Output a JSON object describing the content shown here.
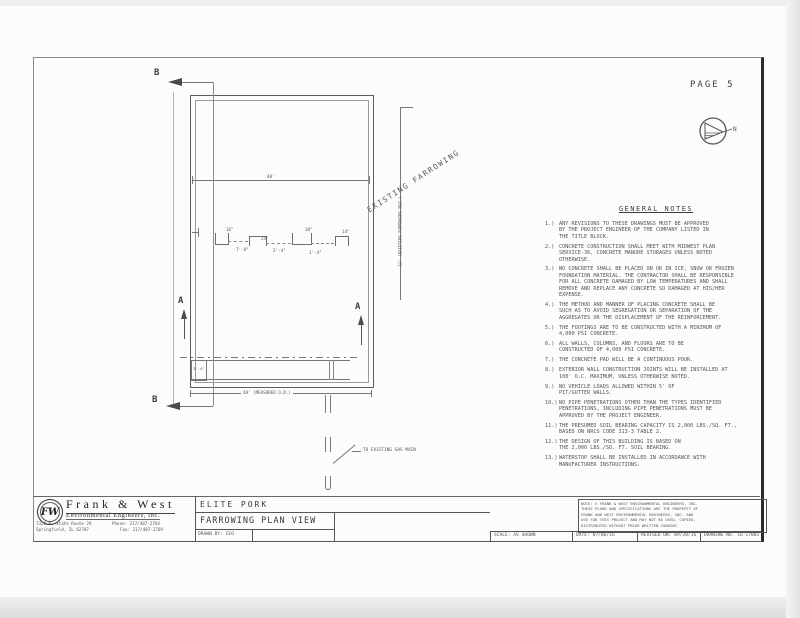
{
  "page": {
    "label": "PAGE 5"
  },
  "colors": {
    "ink": "#4a4a4a",
    "line": "#777777",
    "paper": "#fcfcfa"
  },
  "north_arrow": {
    "label": "N"
  },
  "plan": {
    "existing_building_label": "EXISTING FARROWING",
    "existing_building_dim": "11' (EXISTING FARROWING BLD.)",
    "gas_main_label": "TO EXISTING GAS MAIN",
    "overall_width_dim": "48'",
    "bottom_dim": "48' (MEASURED O.D.)",
    "pit_dim": "3'-4\"",
    "section_a_label": "A",
    "section_b_label": "B",
    "detail_dims": [
      "16\"",
      "24\"",
      "30\"",
      "14\"",
      "7'-0\"",
      "2'-4\"",
      "1'-4\""
    ]
  },
  "notes": {
    "title": "GENERAL NOTES",
    "items": [
      {
        "num": "1.)",
        "text": "ANY REVISIONS TO THESE DRAWINGS MUST BE APPROVED\nBY THE PROJECT ENGINEER OF THE COMPANY LISTED IN\nTHE TITLE BLOCK."
      },
      {
        "num": "2.)",
        "text": "CONCRETE CONSTRUCTION SHALL MEET WITH MIDWEST PLAN\nSERVICE-36, CONCRETE MANURE STORAGES UNLESS NOTED\nOTHERWISE."
      },
      {
        "num": "3.)",
        "text": "NO CONCRETE SHALL BE PLACED ON OR IN ICE, SNOW OR FROZEN\nFOUNDATION MATERIAL. THE CONTRACTOR SHALL BE RESPONSIBLE\nFOR ALL CONCRETE DAMAGED BY LOW TEMPERATURES AND SHALL\nREMOVE AND REPLACE ANY CONCRETE SO DAMAGED AT HIS/HER\nEXPENSE."
      },
      {
        "num": "4.)",
        "text": "THE METHOD AND MANNER OF PLACING CONCRETE SHALL BE\nSUCH AS TO AVOID SEGREGATION OR SEPARATION OF THE\nAGGREGATES OR THE DISPLACEMENT OF THE REINFORCEMENT."
      },
      {
        "num": "5.)",
        "text": "THE FOOTINGS ARE TO BE CONSTRUCTED WITH A MINIMUM OF\n4,000 PSI CONCRETE."
      },
      {
        "num": "6.)",
        "text": "ALL WALLS, COLUMNS, AND FLOORS ARE TO BE\nCONSTRUCTED OF 4,000 PSI CONCRETE."
      },
      {
        "num": "7.)",
        "text": "THE CONCRETE PAD WILL BE A CONTINUOUS POUR."
      },
      {
        "num": "8.)",
        "text": "EXTERIOR WALL CONSTRUCTION JOINTS WILL BE INSTALLED AT\n100' O.C. MAXIMUM, UNLESS OTHERWISE NOTED."
      },
      {
        "num": "9.)",
        "text": "NO VEHICLE LOADS ALLOWED WITHIN 5' OF\nPIT/GUTTER WALLS."
      },
      {
        "num": "10.)",
        "text": "NO PIPE PENETRATIONS OTHER THAN THE TYPES IDENTIFIED\nPENETRATIONS, INCLUDING PIPE PENETRATIONS MUST BE\nAPPROVED BY THE PROJECT ENGINEER."
      },
      {
        "num": "11.)",
        "text": "THE PRESUMED SOIL BEARING CAPACITY IS 2,000 LBS./SQ. FT.,\nBASED ON NRCS CODE 313-3 TABLE 2."
      },
      {
        "num": "12.)",
        "text": "THE DESIGN OF THIS BUILDING IS BASED ON\nTHE 2,000 LBS./SQ. FT. SOIL BEARING."
      },
      {
        "num": "13.)",
        "text": "WATERSTOP SHALL BE INSTALLED IN ACCORDANCE WITH\nMANUFACTURER INSTRUCTIONS."
      }
    ]
  },
  "titleblock": {
    "company": {
      "logo": "FW",
      "name": "Frank & West",
      "subtitle": "Environmental Engineers, Inc.",
      "address1": "7328 N. State Route 29",
      "address2": "Springfield, IL 62707",
      "phone": "Phone: 217/487-2764",
      "fax": "Fax: 217/487-2769"
    },
    "project": "ELITE PORK",
    "sheet_title": "FARROWING PLAN VIEW",
    "drawn_by": "DRAWN BY: CEO",
    "disclaimer": "NOTE: © FRANK & WEST ENVIRONMENTAL ENGINEERS, INC.\nTHESE PLANS AND SPECIFICATIONS ARE THE PROPERTY OF\nFRANK AND WEST ENVIRONMENTAL ENGINEERS, INC. AND\nUSE FOR THIS PROJECT AND MAY NOT BE USED, COPIED,\nDISTRIBUTED WITHOUT PRIOR WRITTEN CONSENT.",
    "scale": "SCALE: AS SHOWN",
    "date": "DATE: 07/06/16",
    "revised": "REVISED ON: 09/28/16",
    "drawing_no": "DRAWING NO. 16-17001"
  }
}
